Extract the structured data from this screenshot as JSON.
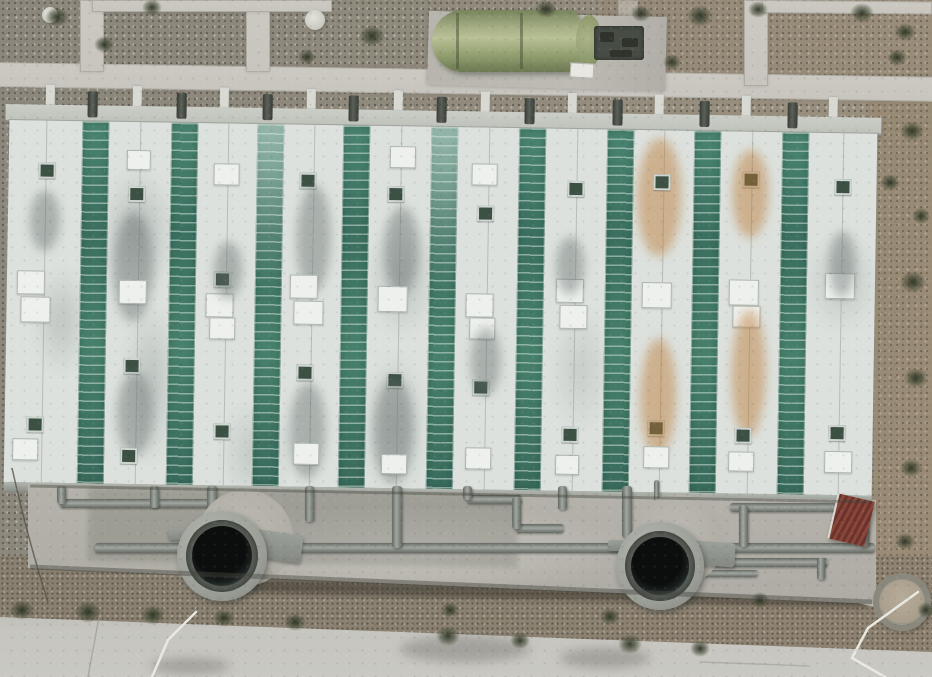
{
  "meta": {
    "image_type": "aerial-drone-photo",
    "subject": "wastewater treatment plant seen from directly above",
    "width": 932,
    "height": 677,
    "visible_text": "none"
  },
  "palette": {
    "gravel_gray": "#8e897d",
    "gravel_brown": "#9a9080",
    "dirt": "#8b8171",
    "concrete_path": "#c9c7c0",
    "apron": "#b1afa7",
    "road": "#c6c5bf",
    "roof_white": "#dce1dd",
    "roof_green": "#417a67",
    "roof_green_slat": "#79a893",
    "hatch_dark": "#3c5044",
    "panel_white": "#edf0ed",
    "pipe_gray": "#848a84",
    "tank_ring": "#a4a7a1",
    "tank_dark": "#111413",
    "fiberglass_green": "#a3ad81",
    "shed_red": "#7c3b31",
    "shrub_green": "#39402c",
    "rust": "#b97a3c"
  },
  "paths": [
    {
      "name": "path-top-horizontal",
      "x": -4,
      "y": 62,
      "w": 944,
      "h": 25,
      "rot": 0.9
    },
    {
      "name": "path-vertical-left",
      "x": 80,
      "y": 0,
      "w": 24,
      "h": 72,
      "rot": 0
    },
    {
      "name": "path-vertical-mid",
      "x": 246,
      "y": 0,
      "w": 24,
      "h": 72,
      "rot": 0
    },
    {
      "name": "path-vertical-right",
      "x": 744,
      "y": 0,
      "w": 24,
      "h": 86,
      "rot": 0
    },
    {
      "name": "path-top-edge-left",
      "x": 92,
      "y": 0,
      "w": 240,
      "h": 12,
      "rot": 0
    },
    {
      "name": "path-top-edge-right",
      "x": 762,
      "y": 0,
      "w": 170,
      "h": 13,
      "rot": 0.5
    },
    {
      "name": "path-vertical-faint",
      "x": 618,
      "y": 0,
      "w": 20,
      "h": 78,
      "rot": 0,
      "faint": true
    },
    {
      "name": "path-pit-spur",
      "x": 840,
      "y": 580,
      "w": 72,
      "h": 18,
      "rot": 14
    }
  ],
  "building": {
    "x": 6,
    "y": 84,
    "w": 880,
    "h": 412,
    "rotation_deg": 0.9,
    "fence_posts": {
      "start": 40,
      "step": 87,
      "count": 10,
      "w": 9,
      "h": 20,
      "y": 0
    },
    "pipe_stubs": {
      "centers": [
        87,
        176,
        262,
        348,
        436,
        524,
        612,
        699,
        787
      ],
      "w": 10,
      "h": 26,
      "y": 6
    },
    "wall": {
      "x": 0,
      "y": 20,
      "w": 876,
      "h": 16
    },
    "roof": {
      "x": 4,
      "y": 36,
      "w": 868,
      "h": 362
    },
    "stripe_width": 27,
    "green_stripes": [
      {
        "x": 73,
        "light": false
      },
      {
        "x": 162,
        "light": false
      },
      {
        "x": 248,
        "light": true
      },
      {
        "x": 334,
        "light": false
      },
      {
        "x": 422,
        "light": true
      },
      {
        "x": 510,
        "light": false
      },
      {
        "x": 598,
        "light": false
      },
      {
        "x": 685,
        "light": false
      },
      {
        "x": 773,
        "light": false
      }
    ],
    "white_stripes": [
      {
        "x": 0,
        "w": 73,
        "features": [
          {
            "t": "hatch",
            "x": 30,
            "y": 42
          },
          {
            "t": "panel",
            "x": 10,
            "y": 150,
            "w": 26,
            "h": 22
          },
          {
            "t": "panel",
            "x": 14,
            "y": 176,
            "w": 28,
            "h": 24
          },
          {
            "t": "hatch",
            "x": 22,
            "y": 296
          },
          {
            "t": "panel",
            "x": 8,
            "y": 318,
            "w": 24,
            "h": 20
          },
          {
            "t": "stain",
            "x": 28,
            "y": 70,
            "w": 30,
            "h": 60
          }
        ]
      },
      {
        "x": 100,
        "w": 62,
        "features": [
          {
            "t": "panel",
            "x": 18,
            "y": 28,
            "w": 22,
            "h": 18
          },
          {
            "t": "hatch",
            "x": 20,
            "y": 64
          },
          {
            "t": "stain",
            "x": 12,
            "y": 90,
            "w": 40,
            "h": 110
          },
          {
            "t": "panel",
            "x": 12,
            "y": 158,
            "w": 26,
            "h": 22
          },
          {
            "t": "hatch",
            "x": 18,
            "y": 236
          },
          {
            "t": "stain",
            "x": 18,
            "y": 250,
            "w": 36,
            "h": 84
          },
          {
            "t": "hatch",
            "x": 16,
            "y": 326
          }
        ]
      },
      {
        "x": 189,
        "w": 59,
        "features": [
          {
            "t": "panel",
            "x": 16,
            "y": 40,
            "w": 24,
            "h": 20
          },
          {
            "t": "hatch",
            "x": 18,
            "y": 148
          },
          {
            "t": "panel",
            "x": 10,
            "y": 170,
            "w": 26,
            "h": 22
          },
          {
            "t": "panel",
            "x": 14,
            "y": 194,
            "w": 24,
            "h": 20
          },
          {
            "t": "hatch",
            "x": 20,
            "y": 300
          },
          {
            "t": "stain",
            "x": 24,
            "y": 118,
            "w": 28,
            "h": 58
          }
        ]
      },
      {
        "x": 275,
        "w": 59,
        "features": [
          {
            "t": "hatch",
            "x": 16,
            "y": 48
          },
          {
            "t": "stain",
            "x": 20,
            "y": 60,
            "w": 34,
            "h": 108
          },
          {
            "t": "panel",
            "x": 8,
            "y": 150,
            "w": 26,
            "h": 22
          },
          {
            "t": "panel",
            "x": 12,
            "y": 176,
            "w": 28,
            "h": 22
          },
          {
            "t": "hatch",
            "x": 16,
            "y": 240
          },
          {
            "t": "stain",
            "x": 16,
            "y": 258,
            "w": 36,
            "h": 96
          },
          {
            "t": "panel",
            "x": 14,
            "y": 318,
            "w": 24,
            "h": 20
          }
        ]
      },
      {
        "x": 361,
        "w": 61,
        "features": [
          {
            "t": "panel",
            "x": 20,
            "y": 20,
            "w": 24,
            "h": 20
          },
          {
            "t": "hatch",
            "x": 18,
            "y": 60
          },
          {
            "t": "stain",
            "x": 22,
            "y": 80,
            "w": 34,
            "h": 88
          },
          {
            "t": "panel",
            "x": 10,
            "y": 160,
            "w": 28,
            "h": 24
          },
          {
            "t": "hatch",
            "x": 20,
            "y": 246
          },
          {
            "t": "stain",
            "x": 14,
            "y": 252,
            "w": 40,
            "h": 104
          },
          {
            "t": "panel",
            "x": 16,
            "y": 328,
            "w": 24,
            "h": 18
          }
        ]
      },
      {
        "x": 449,
        "w": 61,
        "features": [
          {
            "t": "panel",
            "x": 14,
            "y": 36,
            "w": 24,
            "h": 20
          },
          {
            "t": "hatch",
            "x": 20,
            "y": 78
          },
          {
            "t": "panel",
            "x": 10,
            "y": 166,
            "w": 26,
            "h": 22
          },
          {
            "t": "panel",
            "x": 14,
            "y": 190,
            "w": 24,
            "h": 20
          },
          {
            "t": "hatch",
            "x": 18,
            "y": 252
          },
          {
            "t": "stain",
            "x": 22,
            "y": 200,
            "w": 30,
            "h": 68
          },
          {
            "t": "panel",
            "x": 12,
            "y": 320,
            "w": 24,
            "h": 20
          }
        ]
      },
      {
        "x": 537,
        "w": 61,
        "features": [
          {
            "t": "hatch",
            "x": 22,
            "y": 52
          },
          {
            "t": "panel",
            "x": 12,
            "y": 150,
            "w": 26,
            "h": 22
          },
          {
            "t": "panel",
            "x": 16,
            "y": 176,
            "w": 26,
            "h": 22
          },
          {
            "t": "hatch",
            "x": 20,
            "y": 298
          },
          {
            "t": "stain",
            "x": 18,
            "y": 108,
            "w": 28,
            "h": 58
          },
          {
            "t": "panel",
            "x": 14,
            "y": 326,
            "w": 22,
            "h": 18
          }
        ]
      },
      {
        "x": 625,
        "w": 60,
        "features": [
          {
            "t": "rust",
            "x": 8,
            "y": 8,
            "w": 44,
            "h": 118
          },
          {
            "t": "hatch",
            "x": 20,
            "y": 44
          },
          {
            "t": "panel",
            "x": 10,
            "y": 152,
            "w": 28,
            "h": 24
          },
          {
            "t": "hatch",
            "x": 18,
            "y": 290
          },
          {
            "t": "rust",
            "x": 14,
            "y": 208,
            "w": 36,
            "h": 118
          },
          {
            "t": "panel",
            "x": 14,
            "y": 316,
            "w": 24,
            "h": 20
          }
        ]
      },
      {
        "x": 712,
        "w": 61,
        "features": [
          {
            "t": "hatch",
            "x": 22,
            "y": 40
          },
          {
            "t": "rust",
            "x": 16,
            "y": 18,
            "w": 36,
            "h": 88
          },
          {
            "t": "panel",
            "x": 10,
            "y": 148,
            "w": 28,
            "h": 24
          },
          {
            "t": "panel",
            "x": 14,
            "y": 174,
            "w": 26,
            "h": 20
          },
          {
            "t": "rust",
            "x": 18,
            "y": 178,
            "w": 34,
            "h": 128
          },
          {
            "t": "hatch",
            "x": 18,
            "y": 296
          },
          {
            "t": "panel",
            "x": 12,
            "y": 320,
            "w": 24,
            "h": 18
          }
        ]
      },
      {
        "x": 800,
        "w": 68,
        "features": [
          {
            "t": "hatch",
            "x": 26,
            "y": 46
          },
          {
            "t": "panel",
            "x": 18,
            "y": 140,
            "w": 28,
            "h": 24
          },
          {
            "t": "hatch",
            "x": 24,
            "y": 292
          },
          {
            "t": "stain",
            "x": 28,
            "y": 98,
            "w": 26,
            "h": 66
          },
          {
            "t": "panel",
            "x": 20,
            "y": 318,
            "w": 26,
            "h": 20
          }
        ]
      }
    ],
    "bottom_wall": {
      "x": 4,
      "y": 398,
      "w": 868,
      "h": 10
    }
  },
  "apron": {
    "x": 28,
    "y": 478,
    "w": 848,
    "h": 130,
    "clip": "polygon(0 6px, 848px 22px, 848px 126px, 0 90px)",
    "dark_panel": {
      "x": 60,
      "y": 12,
      "w": 430,
      "h": 74
    }
  },
  "pipes": [
    {
      "x": 60,
      "y": 499,
      "w": 170,
      "h": 9
    },
    {
      "x": 95,
      "y": 543,
      "w": 780,
      "h": 10
    },
    {
      "x": 467,
      "y": 495,
      "w": 55,
      "h": 9
    },
    {
      "x": 516,
      "y": 524,
      "w": 48,
      "h": 9
    },
    {
      "x": 730,
      "y": 503,
      "w": 140,
      "h": 9
    },
    {
      "x": 700,
      "y": 558,
      "w": 128,
      "h": 9
    },
    {
      "x": 702,
      "y": 570,
      "w": 56,
      "h": 7
    },
    {
      "x": 57,
      "y": 486,
      "w": 9,
      "h": 18
    },
    {
      "x": 150,
      "y": 486,
      "w": 9,
      "h": 22
    },
    {
      "x": 207,
      "y": 486,
      "w": 10,
      "h": 28
    },
    {
      "x": 222,
      "y": 499,
      "w": 9,
      "h": 48
    },
    {
      "x": 305,
      "y": 486,
      "w": 9,
      "h": 36
    },
    {
      "x": 392,
      "y": 486,
      "w": 10,
      "h": 62
    },
    {
      "x": 463,
      "y": 486,
      "w": 9,
      "h": 14
    },
    {
      "x": 512,
      "y": 497,
      "w": 9,
      "h": 32
    },
    {
      "x": 558,
      "y": 486,
      "w": 9,
      "h": 24
    },
    {
      "x": 622,
      "y": 486,
      "w": 10,
      "h": 52
    },
    {
      "x": 739,
      "y": 505,
      "w": 9,
      "h": 42
    },
    {
      "x": 860,
      "y": 505,
      "w": 9,
      "h": 42
    },
    {
      "x": 817,
      "y": 558,
      "w": 8,
      "h": 22
    },
    {
      "x": 654,
      "y": 480,
      "w": 5,
      "h": 50
    }
  ],
  "tanks": [
    {
      "name": "clarifier-tank-left",
      "pad": {
        "cx": 245,
        "cy": 538,
        "r": 48
      },
      "ring": {
        "cx": 222,
        "cy": 556,
        "r": 45
      },
      "mid_r": 36,
      "hole_r": 30,
      "bracket": {
        "x": 252,
        "y": 532,
        "w": 50,
        "h": 28,
        "rot": 8
      },
      "stub": {
        "x": 168,
        "y": 528,
        "w": 18,
        "h": 12
      }
    },
    {
      "name": "clarifier-tank-right",
      "pad": {
        "cx": 678,
        "cy": 540,
        "r": 46
      },
      "ring": {
        "cx": 660,
        "cy": 566,
        "r": 44
      },
      "mid_r": 35,
      "hole_r": 29,
      "bracket": {
        "x": 693,
        "y": 542,
        "w": 42,
        "h": 24,
        "rot": 4
      },
      "stub": {
        "x": 608,
        "y": 540,
        "w": 16,
        "h": 11
      }
    }
  ],
  "fiberglass_tank": {
    "pad": {
      "x": 428,
      "y": 14,
      "w": 238,
      "h": 74,
      "rot": 1.5
    },
    "body": {
      "x": 432,
      "y": 10,
      "w": 148,
      "h": 62
    },
    "cap": {
      "x": 576,
      "y": 15,
      "w": 26,
      "h": 52
    },
    "straps": [
      456,
      520
    ],
    "fittings": {
      "x": 594,
      "y": 26,
      "w": 50,
      "h": 34
    },
    "small_parts": [
      {
        "x": 600,
        "y": 32,
        "w": 14,
        "h": 10
      },
      {
        "x": 622,
        "y": 38,
        "w": 16,
        "h": 9
      },
      {
        "x": 610,
        "y": 50,
        "w": 22,
        "h": 7
      }
    ],
    "white_box": {
      "x": 570,
      "y": 63,
      "w": 22,
      "h": 13
    }
  },
  "discs": [
    {
      "cx": 50,
      "cy": 15,
      "r": 8
    },
    {
      "cx": 315,
      "cy": 20,
      "r": 10
    }
  ],
  "shed": {
    "x": 832,
    "y": 497,
    "w": 36,
    "h": 46,
    "rot": 13
  },
  "pit": {
    "cx": 902,
    "cy": 602,
    "r": 29
  },
  "trench": {
    "x": 235,
    "y": 586,
    "w": 635,
    "h": 14,
    "rot": 1.4
  },
  "road_stains": [
    {
      "x": 400,
      "y": 636,
      "w": 130,
      "h": 26
    },
    {
      "x": 560,
      "y": 648,
      "w": 90,
      "h": 20
    },
    {
      "x": 150,
      "y": 658,
      "w": 80,
      "h": 16
    }
  ],
  "shrubs": [
    {
      "cx": 57,
      "cy": 17,
      "r": 12
    },
    {
      "cx": 104,
      "cy": 44,
      "r": 10
    },
    {
      "cx": 152,
      "cy": 7,
      "r": 10
    },
    {
      "cx": 307,
      "cy": 57,
      "r": 9
    },
    {
      "cx": 372,
      "cy": 36,
      "r": 13
    },
    {
      "cx": 546,
      "cy": 9,
      "r": 11
    },
    {
      "cx": 641,
      "cy": 13,
      "r": 10
    },
    {
      "cx": 700,
      "cy": 16,
      "r": 13
    },
    {
      "cx": 758,
      "cy": 9,
      "r": 10
    },
    {
      "cx": 862,
      "cy": 13,
      "r": 12
    },
    {
      "cx": 897,
      "cy": 57,
      "r": 10
    },
    {
      "cx": 672,
      "cy": 62,
      "r": 9
    },
    {
      "cx": 905,
      "cy": 32,
      "r": 11
    },
    {
      "cx": 912,
      "cy": 131,
      "r": 12
    },
    {
      "cx": 890,
      "cy": 182,
      "r": 10
    },
    {
      "cx": 921,
      "cy": 216,
      "r": 9
    },
    {
      "cx": 913,
      "cy": 282,
      "r": 13
    },
    {
      "cx": 916,
      "cy": 378,
      "r": 12
    },
    {
      "cx": 911,
      "cy": 468,
      "r": 11
    },
    {
      "cx": 905,
      "cy": 541,
      "r": 10
    },
    {
      "cx": 926,
      "cy": 610,
      "r": 9
    },
    {
      "cx": 22,
      "cy": 610,
      "r": 12
    },
    {
      "cx": 88,
      "cy": 612,
      "r": 13
    },
    {
      "cx": 153,
      "cy": 615,
      "r": 12
    },
    {
      "cx": 224,
      "cy": 618,
      "r": 11
    },
    {
      "cx": 295,
      "cy": 622,
      "r": 11
    },
    {
      "cx": 448,
      "cy": 636,
      "r": 12
    },
    {
      "cx": 520,
      "cy": 640,
      "r": 10
    },
    {
      "cx": 630,
      "cy": 644,
      "r": 12
    },
    {
      "cx": 700,
      "cy": 648,
      "r": 10
    },
    {
      "cx": 450,
      "cy": 610,
      "r": 9
    },
    {
      "cx": 610,
      "cy": 616,
      "r": 10
    },
    {
      "cx": 760,
      "cy": 600,
      "r": 9
    }
  ],
  "hoses": [
    {
      "name": "white-hose-left",
      "points": "196,612 168,640 152,677"
    },
    {
      "name": "white-hose-right",
      "points": "918,592 868,628 852,658 885,677"
    }
  ],
  "cable": {
    "name": "thin-cable-left",
    "d": "M12,468 Q28,540 48,602"
  },
  "edge_lines": [
    {
      "name": "apron-top-shadow",
      "x1": 30,
      "y1": 486,
      "x2": 872,
      "y2": 502,
      "color": "rgba(60,64,58,0.4)",
      "w": 3
    },
    {
      "name": "apron-bottom-curb",
      "x1": 30,
      "y1": 567,
      "x2": 872,
      "y2": 602,
      "color": "rgba(70,72,64,0.45)",
      "w": 5
    },
    {
      "name": "road-seam-vertical",
      "x1": 99,
      "y1": 617,
      "x2": 88,
      "y2": 677,
      "color": "rgba(150,150,145,0.6)",
      "w": 1.5
    },
    {
      "name": "road-seam-right",
      "x1": 700,
      "y1": 662,
      "x2": 810,
      "y2": 666,
      "color": "rgba(150,150,145,0.5)",
      "w": 1.5
    }
  ]
}
